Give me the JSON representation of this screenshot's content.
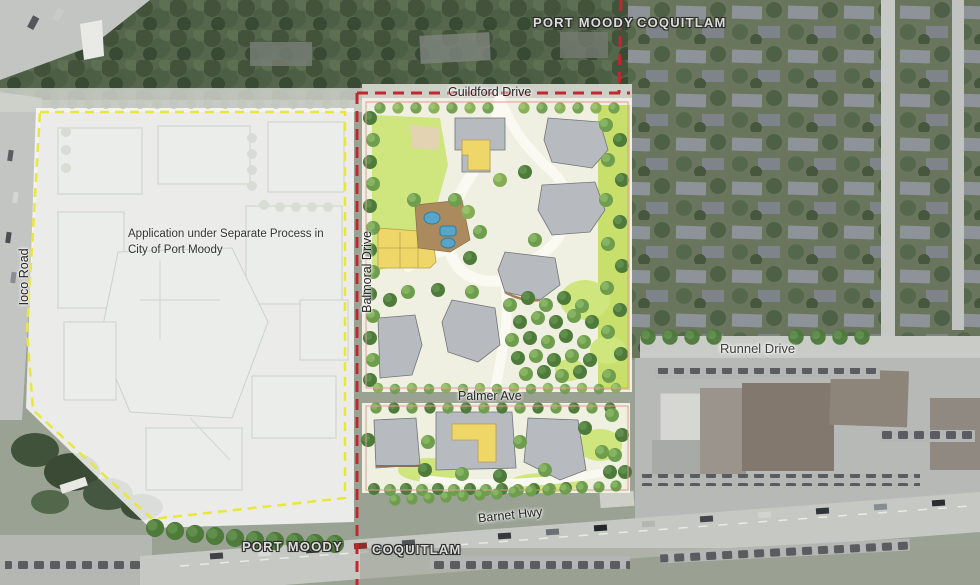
{
  "map": {
    "labels": {
      "city_top_left": "PORT MOODY",
      "city_top_right": "COQUITLAM",
      "city_bottom_left": "PORT MOODY",
      "city_bottom_right": "COQUITLAM",
      "street_guildford": "Guildford Drive",
      "street_balmoral": "Balmoral Drive",
      "street_ioco": "Ioco Road",
      "street_runnel": "Runnel Drive",
      "street_palmer": "Palmer Ave",
      "street_barnet": "Barnet Hwy",
      "note_line1": "Application under Separate Process in",
      "note_line2": "City of Port Moody"
    },
    "colors": {
      "boundary_red": "#c2272d",
      "boundary_yellow": "#e9e63e",
      "lawn_green": "#cfe57e",
      "building_gray": "#b7bbc0",
      "accent_yellow": "#eed768",
      "pool_blue": "#57a6c9"
    }
  }
}
